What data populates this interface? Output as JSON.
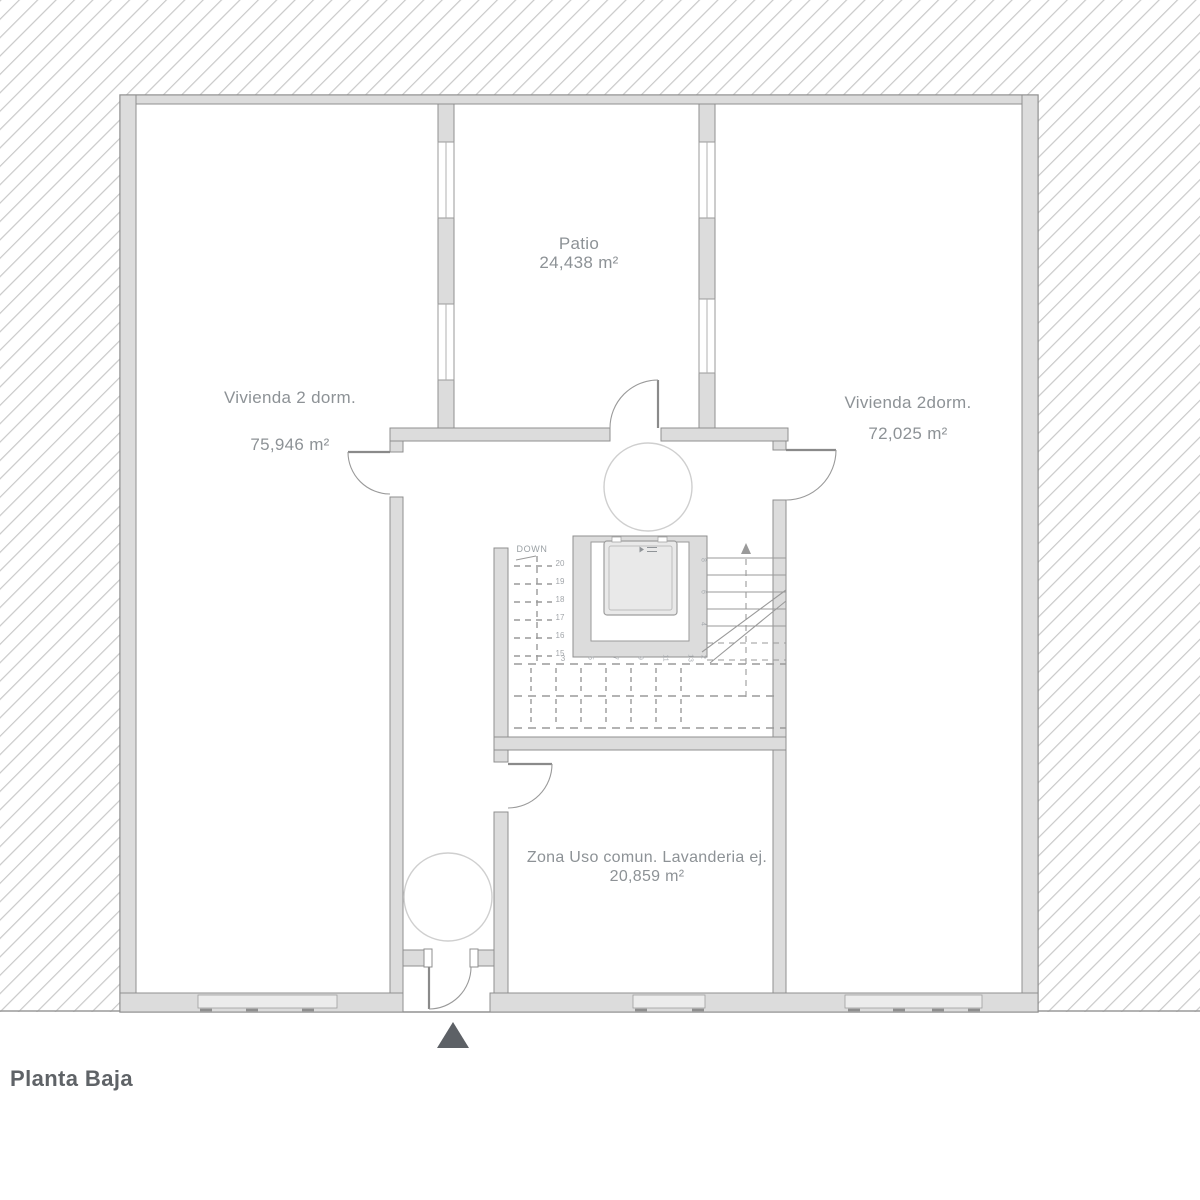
{
  "title": "Planta Baja",
  "rooms": {
    "left_dwelling": {
      "name": "Vivienda 2 dorm.",
      "area": "75,946 m²"
    },
    "patio": {
      "name": "Patio",
      "area": "24,438 m²"
    },
    "right_dwelling": {
      "name": "Vivienda 2dorm.",
      "area": "72,025 m²"
    },
    "laundry": {
      "name": "Zona Uso comun. Lavanderia ej.",
      "area": "20,859 m²"
    }
  },
  "stairs": {
    "down_label": "DOWN",
    "left_run_numbers": [
      "20",
      "19",
      "18",
      "17",
      "16",
      "15"
    ],
    "bottom_run_numbers": [
      "3",
      "5",
      "7",
      "9",
      "11",
      "13"
    ],
    "right_run_numbers": [
      "8",
      "6",
      "4",
      "2"
    ]
  },
  "colors": {
    "hatch_line": "#c9c9c9",
    "wall_fill": "#dcdcdc",
    "wall_stroke": "#8f8f8f",
    "dash_line": "#9a9a9a",
    "label_text": "#8d9296",
    "title_text": "#5f6367",
    "entrance_marker": "#5d6166"
  }
}
